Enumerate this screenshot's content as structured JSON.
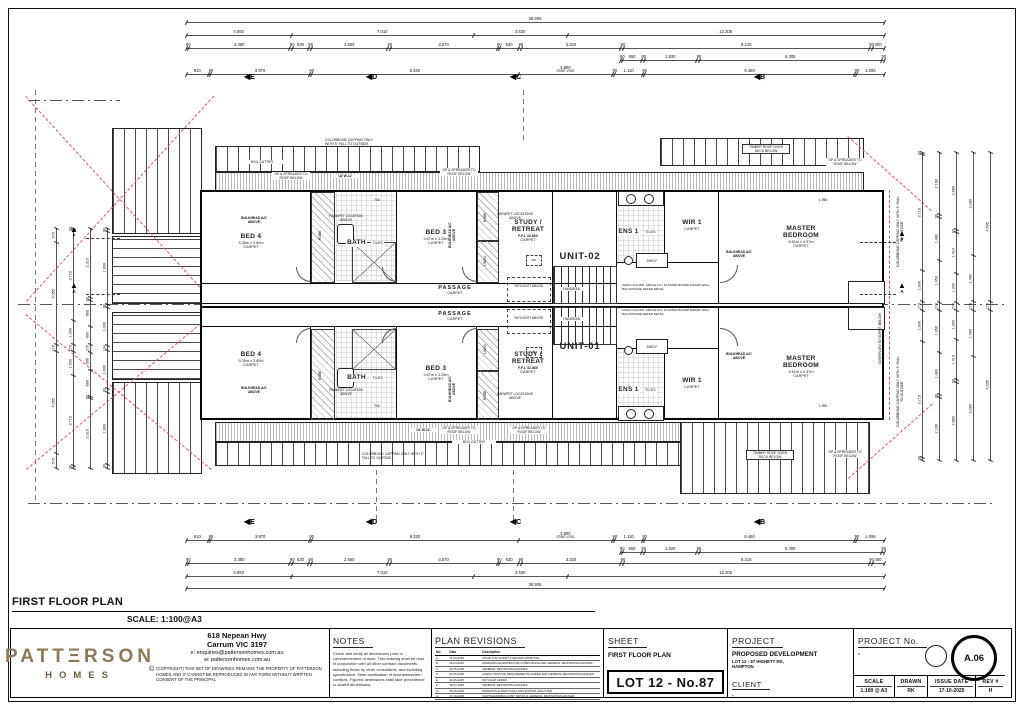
{
  "page": {
    "plan_title": "FIRST FLOOR PLAN",
    "plan_scale": "SCALE: 1:100@A3"
  },
  "units": {
    "upper": "UNIT-02",
    "lower": "UNIT-01"
  },
  "rooms": {
    "bed4": {
      "name": "BED 4",
      "size": "3.35m x 3.80m",
      "finish": "CARPET"
    },
    "bed3": {
      "name": "BED 3",
      "size": "3.57m x 3.28m",
      "finish": "CARPET"
    },
    "bath": {
      "name": "BATH",
      "finish": "TILES"
    },
    "study": {
      "line1": "STUDY /",
      "line2": "RETREAT",
      "ffl": "F.F.L 32.860",
      "finish": "CARPET"
    },
    "ens": {
      "name": "ENS 1",
      "finish": "TILES"
    },
    "wir": {
      "name": "WIR 1",
      "finish": "CARPET"
    },
    "master": {
      "line1": "MASTER",
      "line2": "BEDROOM",
      "size": "5.61m x 4.37m",
      "finish": "CARPET"
    },
    "passage": {
      "name": "PASSAGE",
      "finish": "CARPET"
    }
  },
  "annotations": {
    "bulkhead": "BULKHEAD A/C ABOVE",
    "parapet": "PARAPET LOCATION ABOVE",
    "parapets": "PARAPET LOCATIONS ABOVE",
    "dp": "DP & SPREADER TO ROOF BELOW",
    "box_gutter": "BOX GUTTER",
    "colorbond": "COLORBOND CAPPING ONLY WITH 3° FALL TO OUTSIDE",
    "overflow": "OVERFLOW TO SOFFIT BELOW",
    "timber_roof": "TIMBER ROOF OVER DECK BELOW",
    "skylight": "SKYLIGHT ABOVE",
    "handrail": "HANDRAIL",
    "balustrade": "1000mm(H) MIN. ABOVE F.F.L PLASTER BOARD DWARF WALL BALUSTRADE REFER DETAIL",
    "shelf": "SHELF",
    "linen": "LINEN",
    "robe": "ROBE",
    "mh": "MH",
    "win_u2": "U2 W-12",
    "win_u1": "U1 W-12",
    "dim_740": "740",
    "dim_1950": "1.950"
  },
  "grid_markers": {
    "top": [
      "E",
      "D",
      "C",
      "B"
    ],
    "bottom": [
      "E",
      "D",
      "C",
      "B"
    ],
    "side_upper": "F",
    "side_lower": "A"
  },
  "dims": {
    "overall": [
      "26.905"
    ],
    "spans": [
      "4.060",
      "7.010",
      "3.630",
      "12.205"
    ],
    "detail": [
      "90",
      "3.380",
      "90",
      "530",
      "90",
      "2.550",
      "90",
      "3.570",
      "90",
      "630",
      "90",
      "3.320",
      "90",
      "8.215",
      "90",
      "400"
    ],
    "inner_right": [
      "90",
      "650",
      "90",
      "1.820",
      "90",
      "6.305",
      "90"
    ],
    "wall": [
      "910",
      "90",
      "3.970",
      "90",
      "8.320",
      "3.800|STAIR VOID",
      "90",
      "1.110",
      "90",
      "8.460",
      "90",
      "1.095"
    ],
    "left_chains": [
      [
        "570",
        "4.055",
        "270",
        "4.055",
        "570"
      ],
      [
        "90",
        "3.710",
        "1.000",
        "270",
        "1.000",
        "3.710",
        "90"
      ],
      [
        "2.310",
        "90",
        "860",
        "600",
        "270",
        "600",
        "860",
        "90",
        "2.310"
      ],
      [
        "90",
        "1.900",
        "90",
        "1.000",
        "134",
        "1.000",
        "90",
        "1.900",
        "90"
      ]
    ],
    "right_chains": [
      [
        "90",
        "3.710",
        "1.000",
        "270",
        "1.000",
        "3.710",
        "90"
      ],
      [
        "2.160",
        "90",
        "1.480",
        "1.450",
        "270",
        "1.450",
        "1.480",
        "90",
        "2.160"
      ],
      [
        "2.680",
        "90",
        "1.410",
        "1.000",
        "270",
        "1.000",
        "1.410",
        "90",
        "2.680"
      ],
      [
        "3.280",
        "1.480",
        "270",
        "1.480",
        "3.280"
      ],
      [
        "4.595",
        "270",
        "4.595"
      ]
    ]
  },
  "title_block": {
    "company": {
      "brand": "PATTΞRSON",
      "brand2": "HOMES",
      "address1": "618 Nepean Hwy",
      "address2": "Carrum VIC 3197",
      "email": "e: enquiries@pattersonhomes.com.au",
      "web": "w: pattersonhomes.com.au",
      "copyright_symbol": "©",
      "copyright": "(COPYRIGHT) THIS SET OF DRAWINGS REMAINS THE PROPERTY OF PATTERSON HOMES AND IT CANNOT BE REPRODUCED IN ANY FORM WITHOUT WRITTEN CONSENT OF THE PRINCIPAL"
    },
    "notes": {
      "title": "NOTES",
      "body": "Check and verify all dimensions prior to commencement of work. This drawing shall be read in conjunction with all other contract documents including those by other consultants, and including specification. Seek clarification of inconsistencies / conflicts. Figured dimensions shall take precedence to scaled dimensions."
    },
    "revisions": {
      "title": "PLAN REVISIONS",
      "headers": [
        "No.",
        "Date",
        "Description"
      ],
      "rows": [
        [
          "A",
          "21-03-2025",
          "ISSUE FOR CLIENT & REVIEW APPROVAL"
        ],
        [
          "B",
          "04-04-2025",
          "WINDOWS ADJUSTED FOR COMPLIANCE AND GENERAL REVISIONS/CHANGES"
        ],
        [
          "C",
          "02-05-2025",
          "GENERAL REVISIONS/CHANGES"
        ],
        [
          "D",
          "30-05-2025",
          "AGENCY/ESTATE REQUIREMENTS ADDED AND GENERAL REVISIONS/CHANGES"
        ],
        [
          "E",
          "20-06-2025",
          "SKYLIGHT ADDED"
        ],
        [
          "F",
          "18-07-2025",
          "GENERAL REVISIONS/CHANGES"
        ],
        [
          "G",
          "05-09-2025",
          "WINDOWS & ADDITIONAL PROVISIONS ADJUSTED"
        ],
        [
          "H",
          "17-10-2025",
          "CANTILEVER/BALCONY NOTES & GENERAL REVISIONS/CHANGES"
        ]
      ]
    },
    "sheet": {
      "title": "SHEET",
      "name": "FIRST FLOOR PLAN",
      "lot": "LOT 12 - No.87"
    },
    "project": {
      "title": "PROJECT",
      "name": "PROPOSED DEVELOPMENT",
      "addr1": "LOT 12 - 87 HIGHETT RD,",
      "addr2": "HAMPTON",
      "client_title": "CLIENT",
      "client": "-"
    },
    "project_no": {
      "title": "PROJECT No.",
      "value": "-",
      "rev_circle": "A.06",
      "scale_label": "SCALE",
      "scale": "1:100 @ A3",
      "drawn_label": "DRAWN",
      "drawn": "RK",
      "issue_label": "ISSUE DATE",
      "issue": "17-10-2025",
      "rev_label": "REV #",
      "rev": "H"
    }
  },
  "colors": {
    "brand": "#8b7a55",
    "redline": "#e05858",
    "ink": "#111111"
  }
}
